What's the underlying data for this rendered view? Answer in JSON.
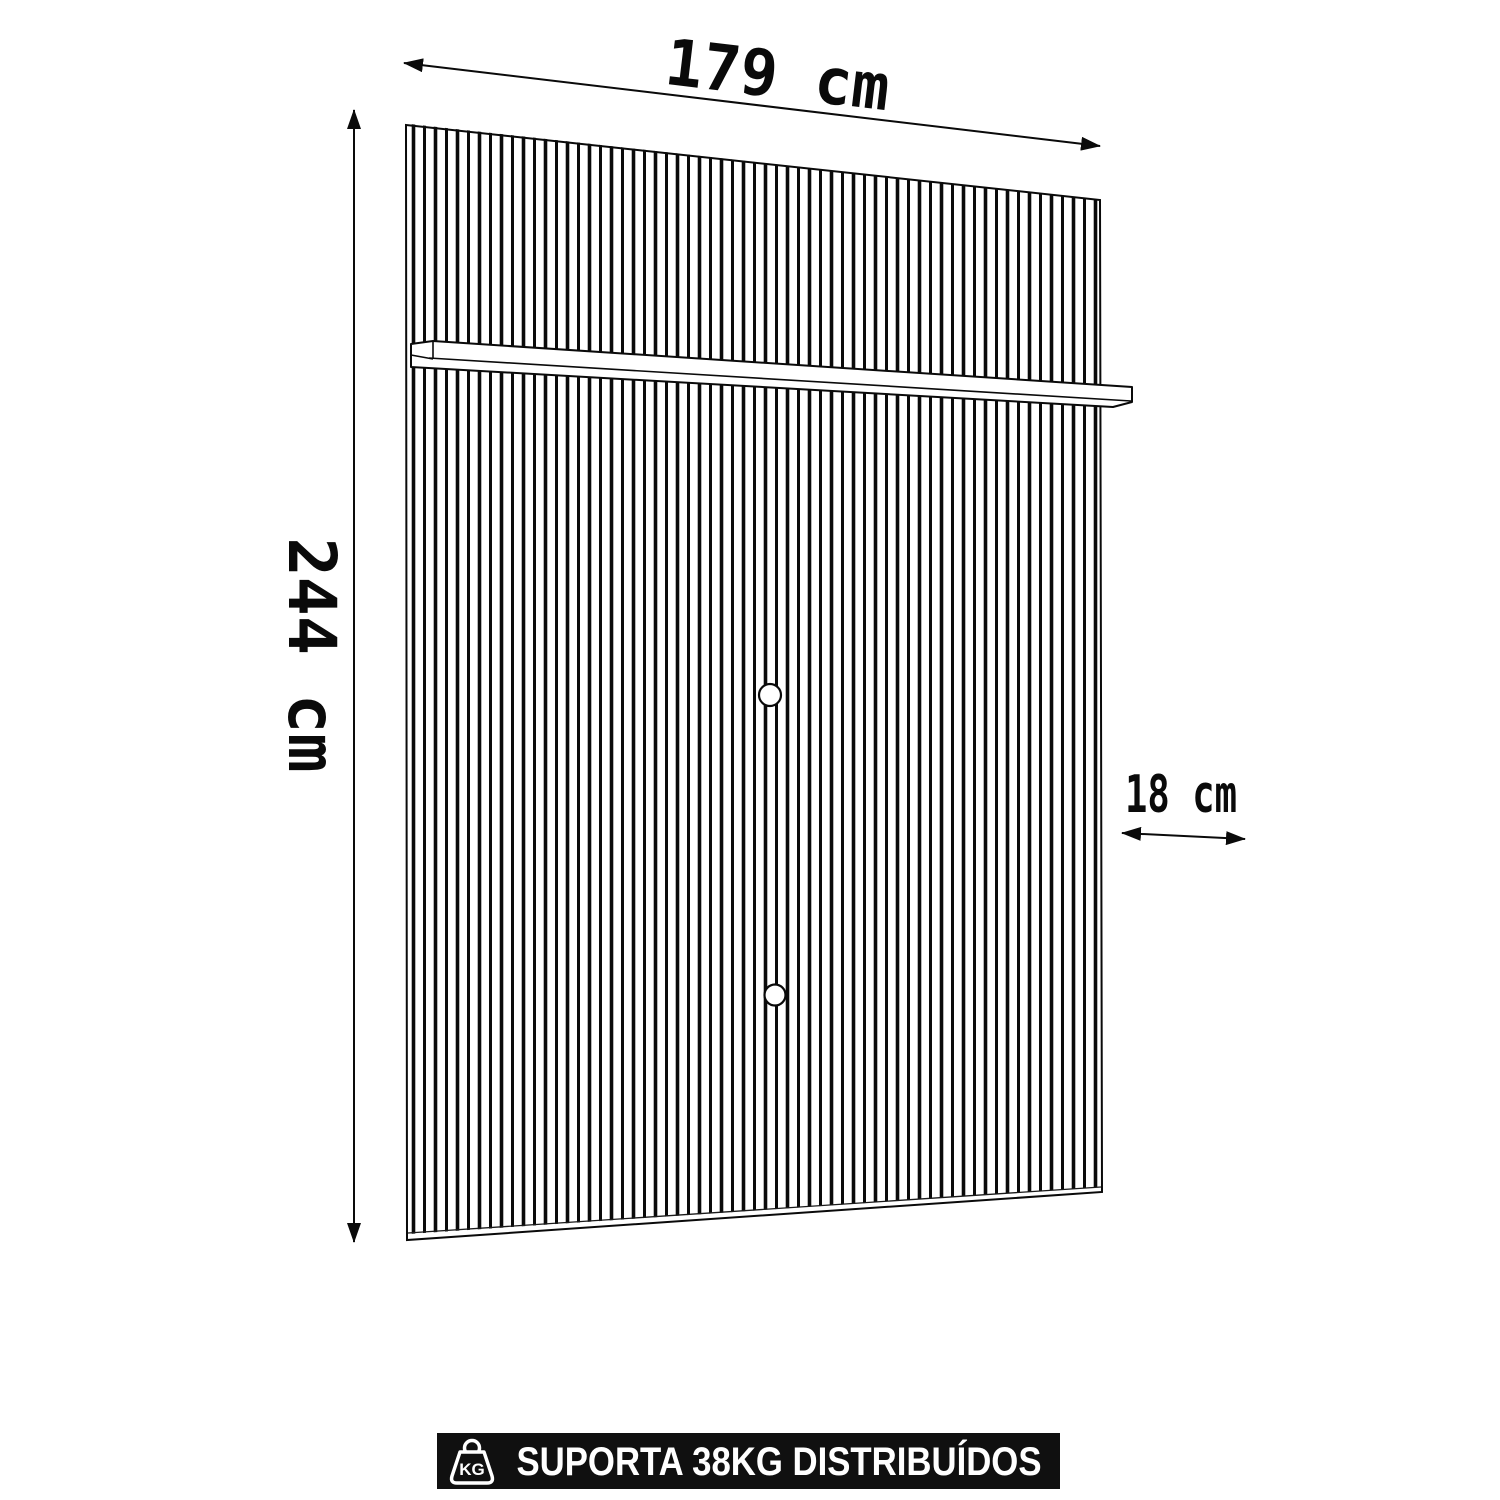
{
  "dimensions": {
    "width": {
      "label": "179 cm"
    },
    "height": {
      "label": "244 cm"
    },
    "depth": {
      "label": "18 cm"
    }
  },
  "banner": {
    "label": "SUPORTA 38KG DISTRIBUÍDOS",
    "icon_text": "KG",
    "background": "#101010",
    "foreground": "#ffffff"
  },
  "colors": {
    "line": "#0a0a0a",
    "panel_fill": "#ffffff"
  }
}
